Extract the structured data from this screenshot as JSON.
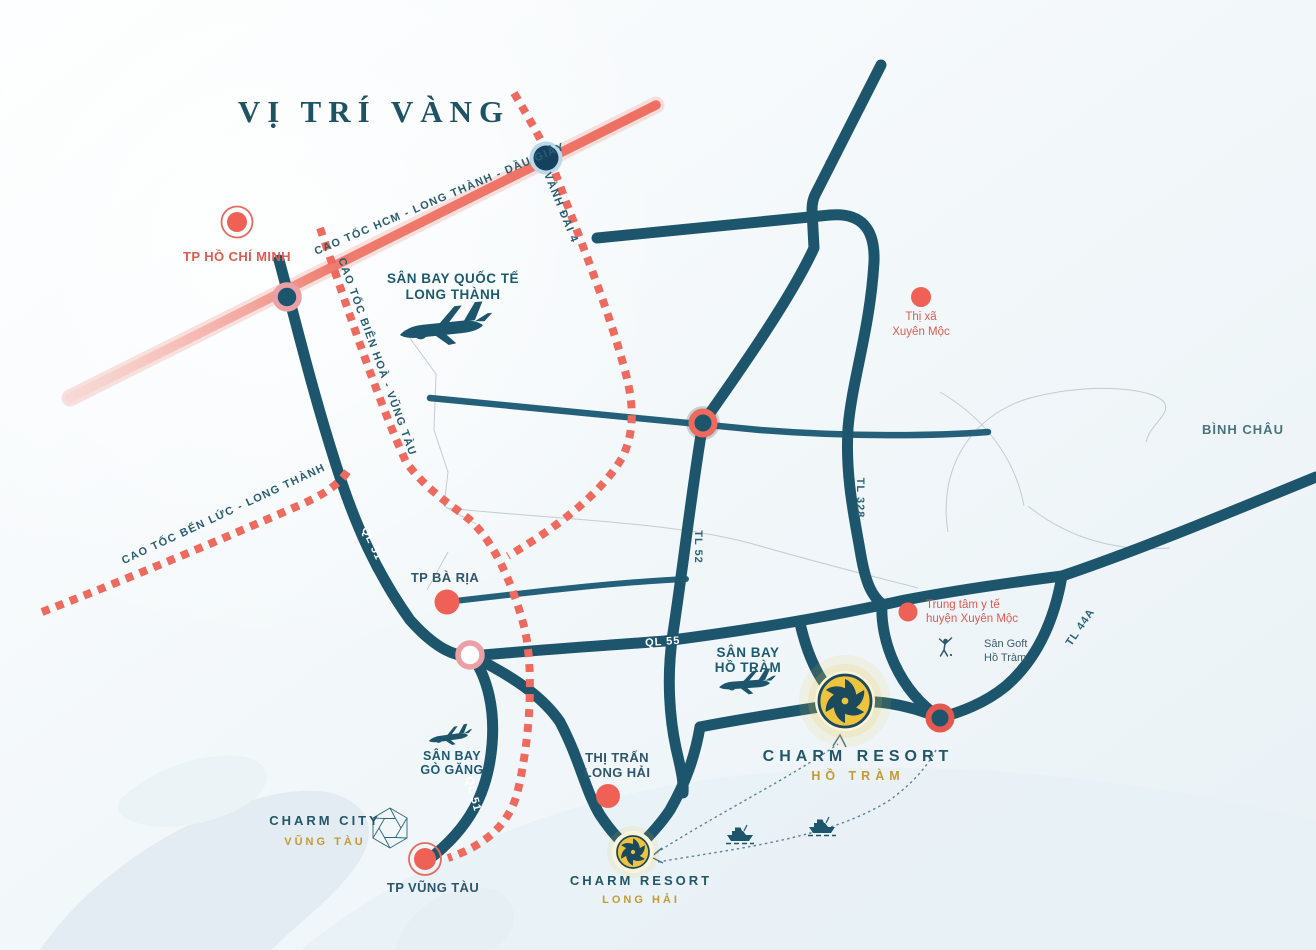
{
  "title": "VỊ TRÍ VÀNG",
  "colors": {
    "road_teal": "#1d566c",
    "expressway_dotted": "#ee6a5f",
    "highway_coral": "#ef7b6f",
    "marker_red": "#ef6157",
    "pink_ring": "#eba0a6",
    "navy_dot": "#16405f",
    "badge_gold": "#eec43e",
    "gold_text": "#c49a32",
    "teal_text": "#235668"
  },
  "highways": {
    "hcm_long_thanh_dau_giay": "CAO TỐC HCM - LONG THÀNH - DẦU GIÂY",
    "vanh_dai_4": "VÀNH ĐAI 4",
    "bien_hoa_vung_tau": "CAO TỐC BIÊN HOÀ - VŨNG TÀU",
    "ben_luc_long_thanh": "CAO TỐC BẾN LỨC - LONG THÀNH",
    "ql51": "QL 51",
    "ql55": "QL 55",
    "tl52": "TL 52",
    "tl328": "TL 328",
    "tl44a": "TL 44A"
  },
  "places": {
    "tp_hcm": "TP HỒ CHÍ MINH",
    "long_thanh_airport": {
      "line1": "SÂN BAY QUỐC TẾ",
      "line2": "LONG THÀNH"
    },
    "xuyen_moc": {
      "line1": "Thị xã",
      "line2": "Xuyên Mộc"
    },
    "binh_chau": "BÌNH CHÂU",
    "tp_ba_ria": "TP BÀ RỊA",
    "medical_center": {
      "line1": "Trung tâm y tế",
      "line2": "huyện Xuyên Mộc"
    },
    "golf": {
      "line1": "Sân Goft",
      "line2": "Hồ Tràm"
    },
    "ho_tram_airport": {
      "line1": "SÂN BAY",
      "line2": "HỒ TRÀM"
    },
    "go_gang_airport": {
      "line1": "SÂN BAY",
      "line2": "GÒ GĂNG"
    },
    "long_hai_town": {
      "line1": "THỊ TRẤN",
      "line2": "LONG HẢI"
    },
    "tp_vung_tau": "TP VŨNG TÀU"
  },
  "projects": {
    "charm_resort_ho_tram": {
      "line1": "CHARM RESORT",
      "line2": "HỒ TRÀM"
    },
    "charm_resort_long_hai": {
      "line1": "CHARM RESORT",
      "line2": "LONG HẢI"
    },
    "charm_city": {
      "line1": "CHARM CITY",
      "line2": "VŨNG TÀU"
    }
  }
}
